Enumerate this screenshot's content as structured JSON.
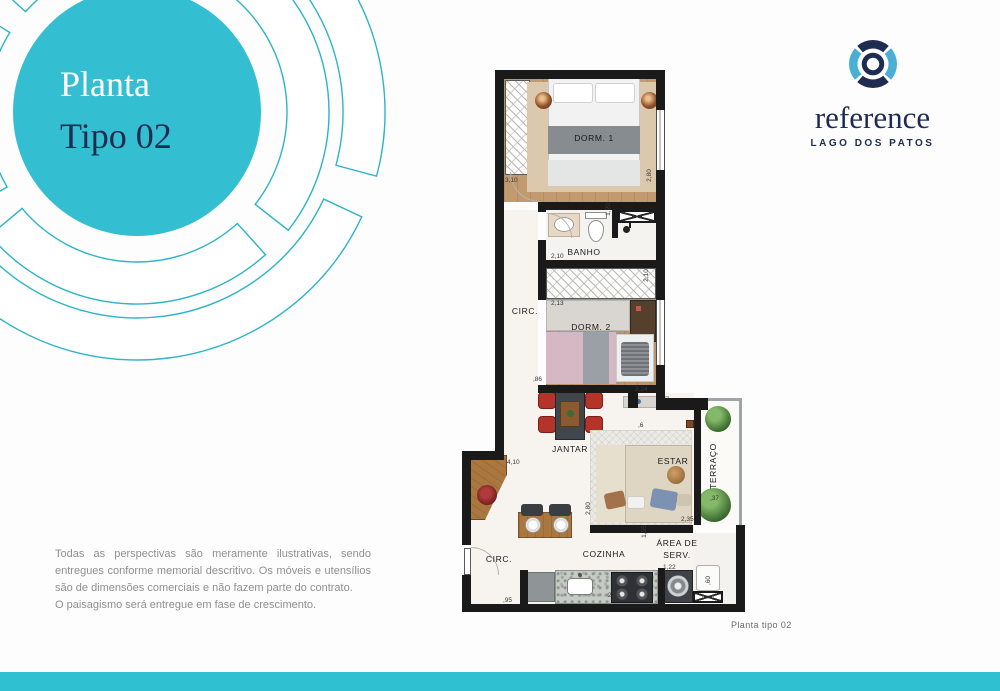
{
  "badge": {
    "line1": "Planta",
    "line2": "Tipo 02"
  },
  "brand": {
    "name": "reference",
    "subtitle": "LAGO DOS PATOS"
  },
  "colors": {
    "teal": "#34bed1",
    "teal_stroke": "#2cb5c7",
    "navy": "#1e2c52",
    "light_blue": "#4aafd5",
    "footer_bar": "#2fc0d2",
    "wall": "#1a1a1a"
  },
  "floorplan": {
    "rooms": {
      "dorm1": "DORM. 1",
      "banho": "BANHO",
      "circ_upper": "CIRC.",
      "dorm2": "DORM. 2",
      "jantar": "JANTAR",
      "estar": "ESTAR",
      "terraco": "TERRAÇO",
      "cozinha": "COZINHA",
      "area_serv_line1": "ÁREA DE",
      "area_serv_line2": "SERV.",
      "circ_lower": "CIRC."
    },
    "dims": {
      "dorm1_w": "3,10",
      "dorm1_d": "2,80",
      "shower": "1,20",
      "banho_w": "2,10",
      "closet_w": "2,13",
      "dorm2_d": "2,10",
      "hall": ",86",
      "nook": "2,24",
      "living_w": "4,10",
      "nook_small": ",6",
      "estar_d": "2,80",
      "estar_w": "2,35",
      "terraco_w": ",37",
      "passage": "1,55",
      "counter": "2,85",
      "washer": "1,22",
      "tank": ",60",
      "entry": ",95"
    }
  },
  "disclaimer": {
    "p1": "Todas as perspectivas são meramente ilustrativas, sendo entregues conforme memorial descritivo. Os móveis e utensílios são de dimensões comerciais e não fazem parte do contrato.",
    "p2": "O paisagismo será entregue em fase de crescimento."
  },
  "caption": "Planta tipo 02"
}
